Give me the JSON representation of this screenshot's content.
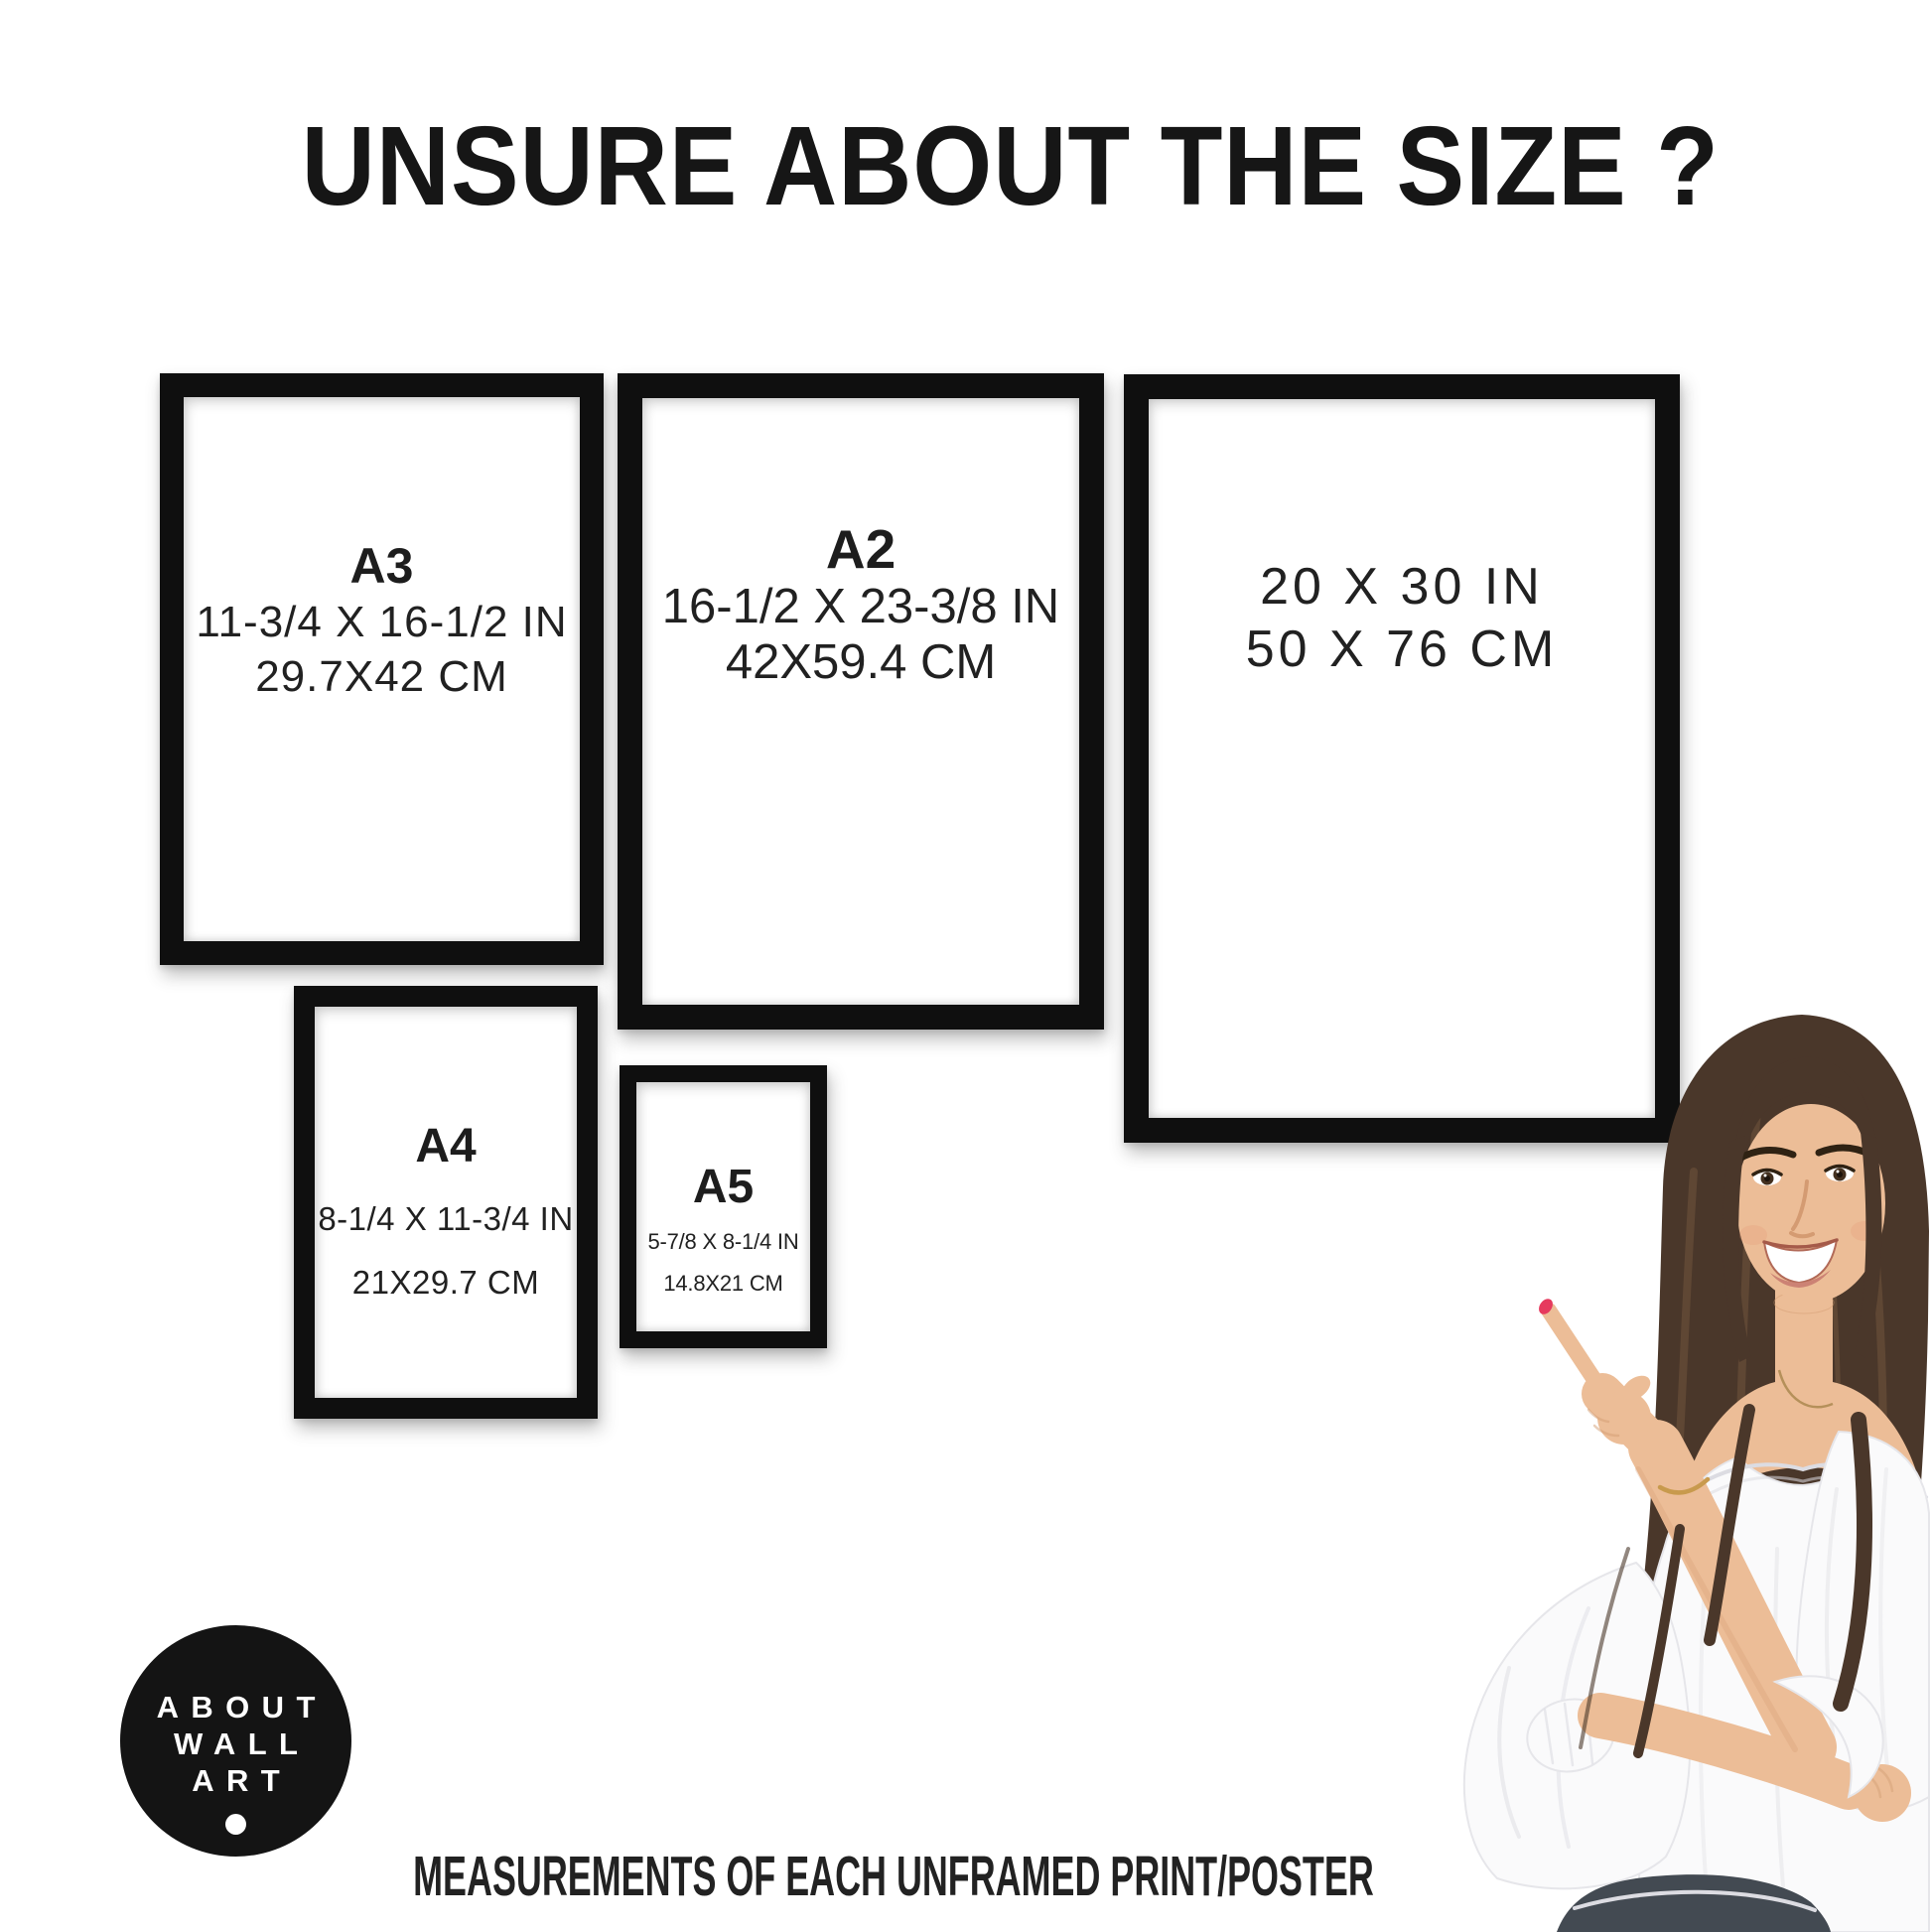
{
  "page": {
    "title": "UNSURE ABOUT THE SIZE ?",
    "caption": "MEASUREMENTS OF EACH UNFRAMED PRINT/POSTER",
    "background": "#ffffff",
    "text_color": "#1d1d1d",
    "frame_color": "#0f0f0f"
  },
  "logo": {
    "line1": "ABOUT",
    "line2": "WALL",
    "line3": "ART",
    "background": "#141414",
    "text_color": "#ffffff"
  },
  "frames": [
    {
      "name": "A3",
      "label": "A3",
      "inches": "11-3/4 X 16-1/2 IN",
      "cm": "29.7X42 CM"
    },
    {
      "name": "A2",
      "label": "A2",
      "inches": "16-1/2 X 23-3/8 IN",
      "cm": "42X59.4 CM"
    },
    {
      "name": "20x30",
      "label": "",
      "inches": "20 X 30 IN",
      "cm": "50 X 76 CM"
    },
    {
      "name": "A4",
      "label": "A4",
      "inches": "8-1/4 X 11-3/4 IN",
      "cm": "21X29.7 CM"
    },
    {
      "name": "A5",
      "label": "A5",
      "inches": "5-7/8 X 8-1/4 IN",
      "cm": "14.8X21 CM"
    }
  ],
  "photo": {
    "subject": "smiling woman with long brown hair pointing at the size chart",
    "colors": {
      "hair": "#4a372a",
      "skin": "#ecbd97",
      "blouse": "#fafafb",
      "nail": "#e63a5e",
      "jeans": "#434a52"
    }
  }
}
